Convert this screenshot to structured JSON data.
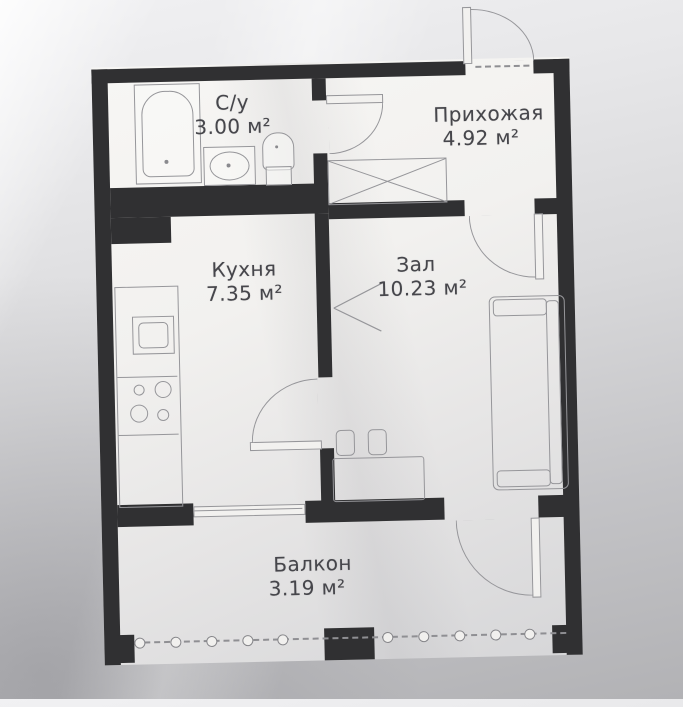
{
  "document": {
    "type": "apartment-floor-plan"
  },
  "rooms": [
    {
      "name": "С/у",
      "area": "3.00 м²"
    },
    {
      "name": "Прихожая",
      "area": "4.92 м²"
    },
    {
      "name": "Кухня",
      "area": "7.35 м²"
    },
    {
      "name": "Зал",
      "area": "10.23 м²"
    },
    {
      "name": "Балкон",
      "area": "3.19 м²"
    }
  ],
  "fixtures": [
    "bathtub",
    "washbasin",
    "toilet",
    "wardrobe",
    "kitchen-counter",
    "kitchen-sink",
    "stove-burners",
    "sofa",
    "table",
    "stool",
    "entrance-door",
    "bathroom-door",
    "kitchen-door",
    "living-room-door",
    "balcony-door",
    "balcony-window",
    "balcony-railing"
  ],
  "colors": {
    "wall": "#303032",
    "paper": "#f2f1ef",
    "line": "#96969a",
    "text": "#46464b",
    "background": "#c9c9cc"
  }
}
